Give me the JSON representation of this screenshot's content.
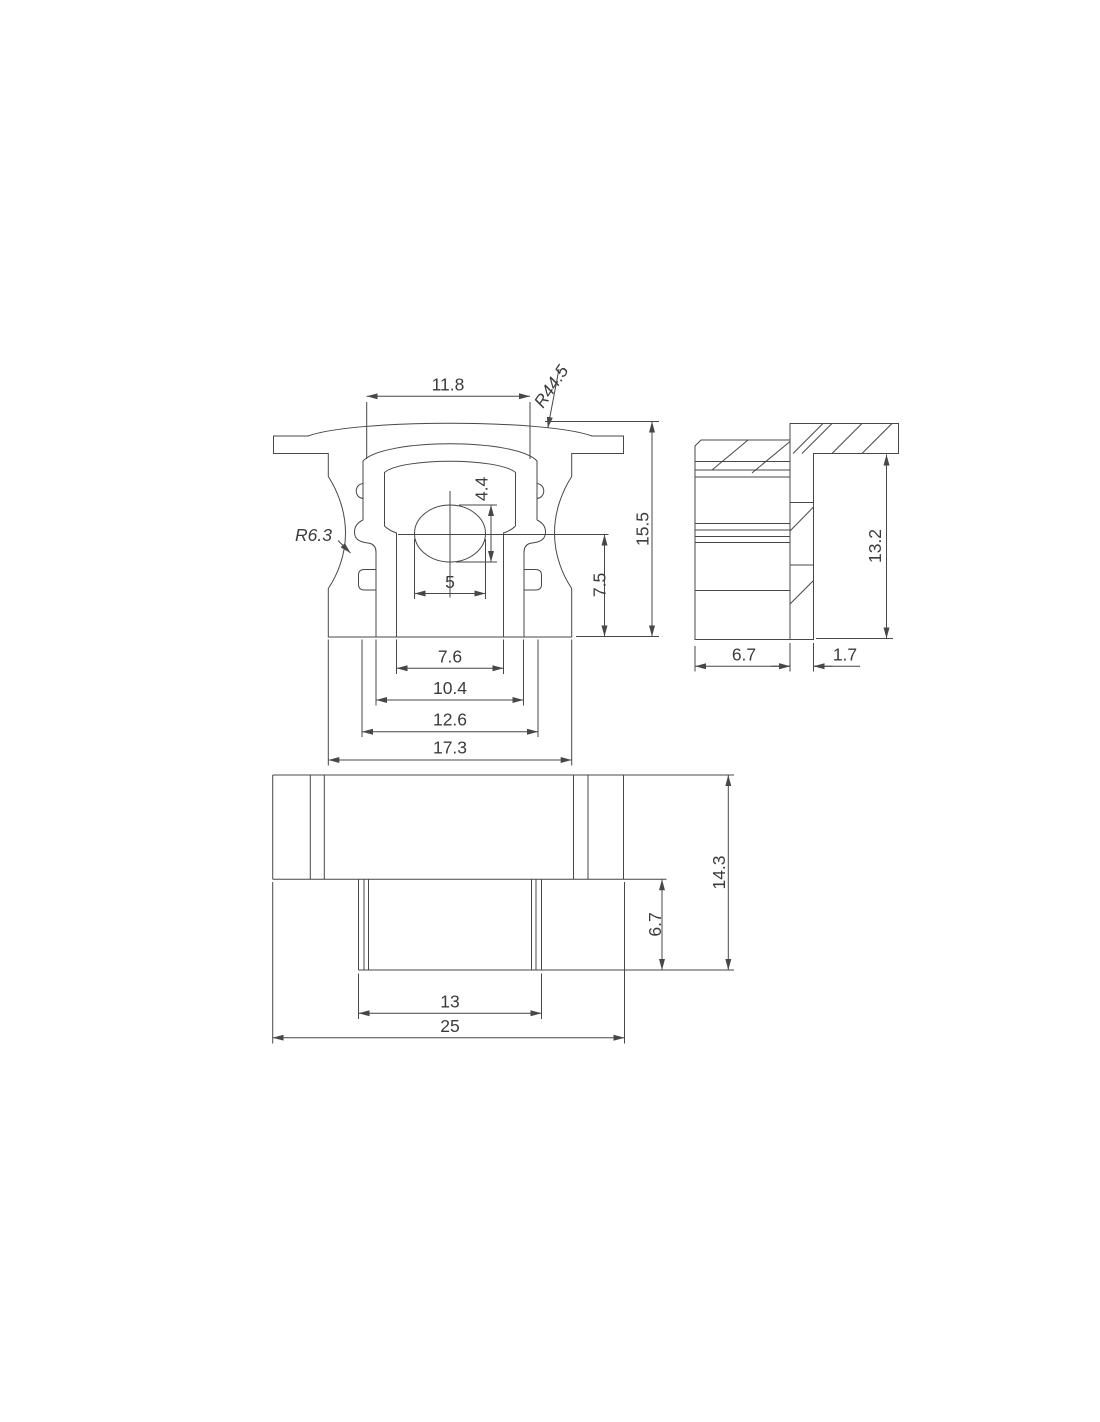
{
  "page": {
    "background": "#ffffff",
    "line_color": "#474747",
    "text_color": "#3c3c3c"
  },
  "drawing": {
    "front": {
      "top_width": "11.8",
      "top_radius": "R44.5",
      "side_radius": "R6.3",
      "hole_height": "4.4",
      "hole_width": "5",
      "lower_height": "7.5",
      "total_height": "15.5",
      "slot_width": "7.6",
      "step_width": "10.4",
      "body_width": "12.6",
      "total_width": "17.3"
    },
    "side": {
      "body_depth": "6.7",
      "flange_thickness": "1.7",
      "height": "13.2"
    },
    "bottom": {
      "body_width": "13",
      "total_width": "25",
      "body_height": "6.7",
      "total_height": "14.3"
    }
  }
}
